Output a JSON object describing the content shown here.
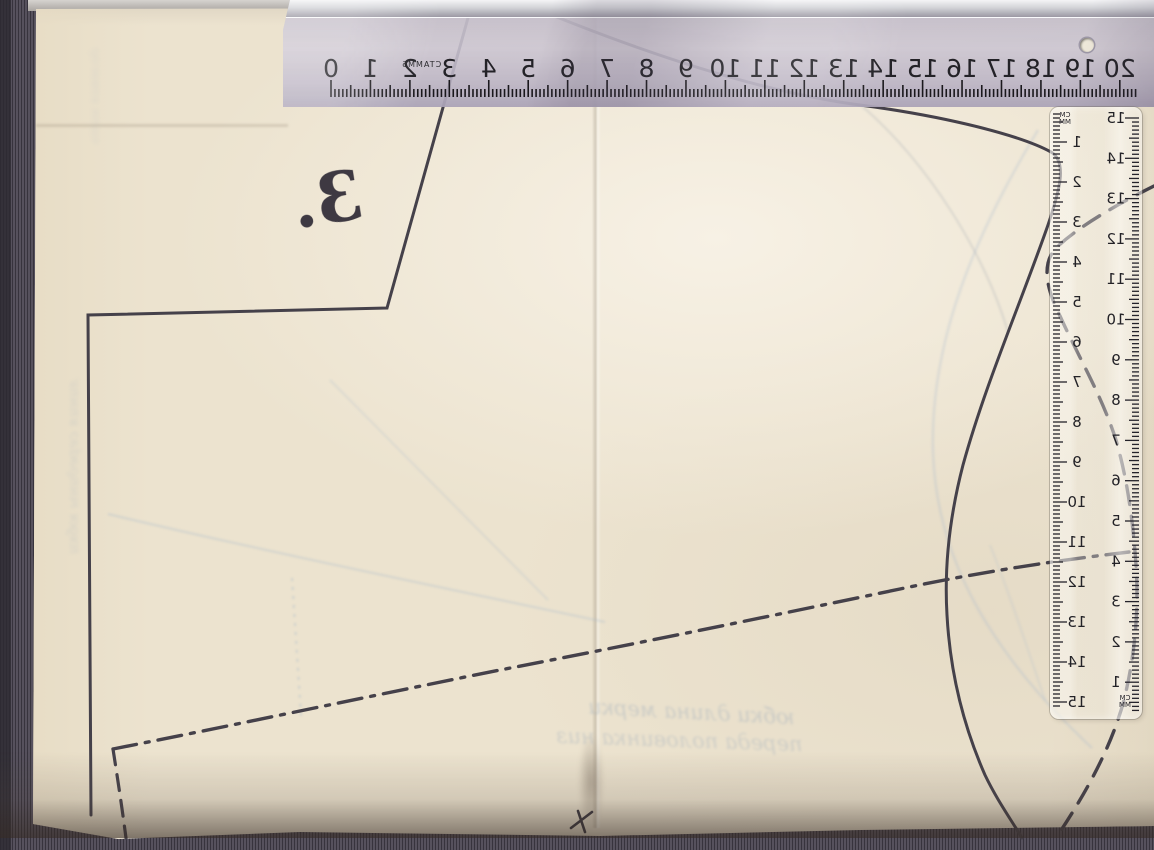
{
  "scene": {
    "description": "Mirrored scan of a paper sewing-pattern sheet with a metal ruler across the top and a transparent ruler on the right",
    "piece_number": "3.",
    "stray_mark": "x"
  },
  "top_ruler": {
    "type": "metal-ruler",
    "mirrored": true,
    "cm_numbers": [
      0,
      1,
      2,
      3,
      4,
      5,
      6,
      7,
      8,
      9,
      10,
      11,
      12,
      13,
      14,
      15,
      16,
      17,
      18,
      19,
      20
    ],
    "brand_mark": "CTAMM5"
  },
  "vertical_ruler": {
    "type": "transparent-ruler",
    "mirrored": true,
    "left_scale": [
      1,
      2,
      3,
      4,
      5,
      6,
      7,
      8,
      9,
      10,
      11,
      12,
      13,
      14,
      15
    ],
    "right_scale": [
      15,
      14,
      13,
      12,
      11,
      10,
      9,
      8,
      7,
      6,
      5,
      4,
      3,
      2,
      1
    ],
    "unit_cm": "CM",
    "unit_mm": "MM"
  },
  "ghost_text": {
    "bottom_line1_approx": "юбки  длина  мерки",
    "bottom_line2_approx": "переда  половинка  низ",
    "left_vertical_approx": "линия  середины  юбки",
    "left_vertical2_approx": "долевая  нить"
  },
  "colors": {
    "paper": "#ece3cf",
    "background_stripe": "#56515d",
    "pattern_line": "#45414a",
    "ghost_blue": "#a4b8cc",
    "metal_ruler_body": "#c3bccd"
  }
}
